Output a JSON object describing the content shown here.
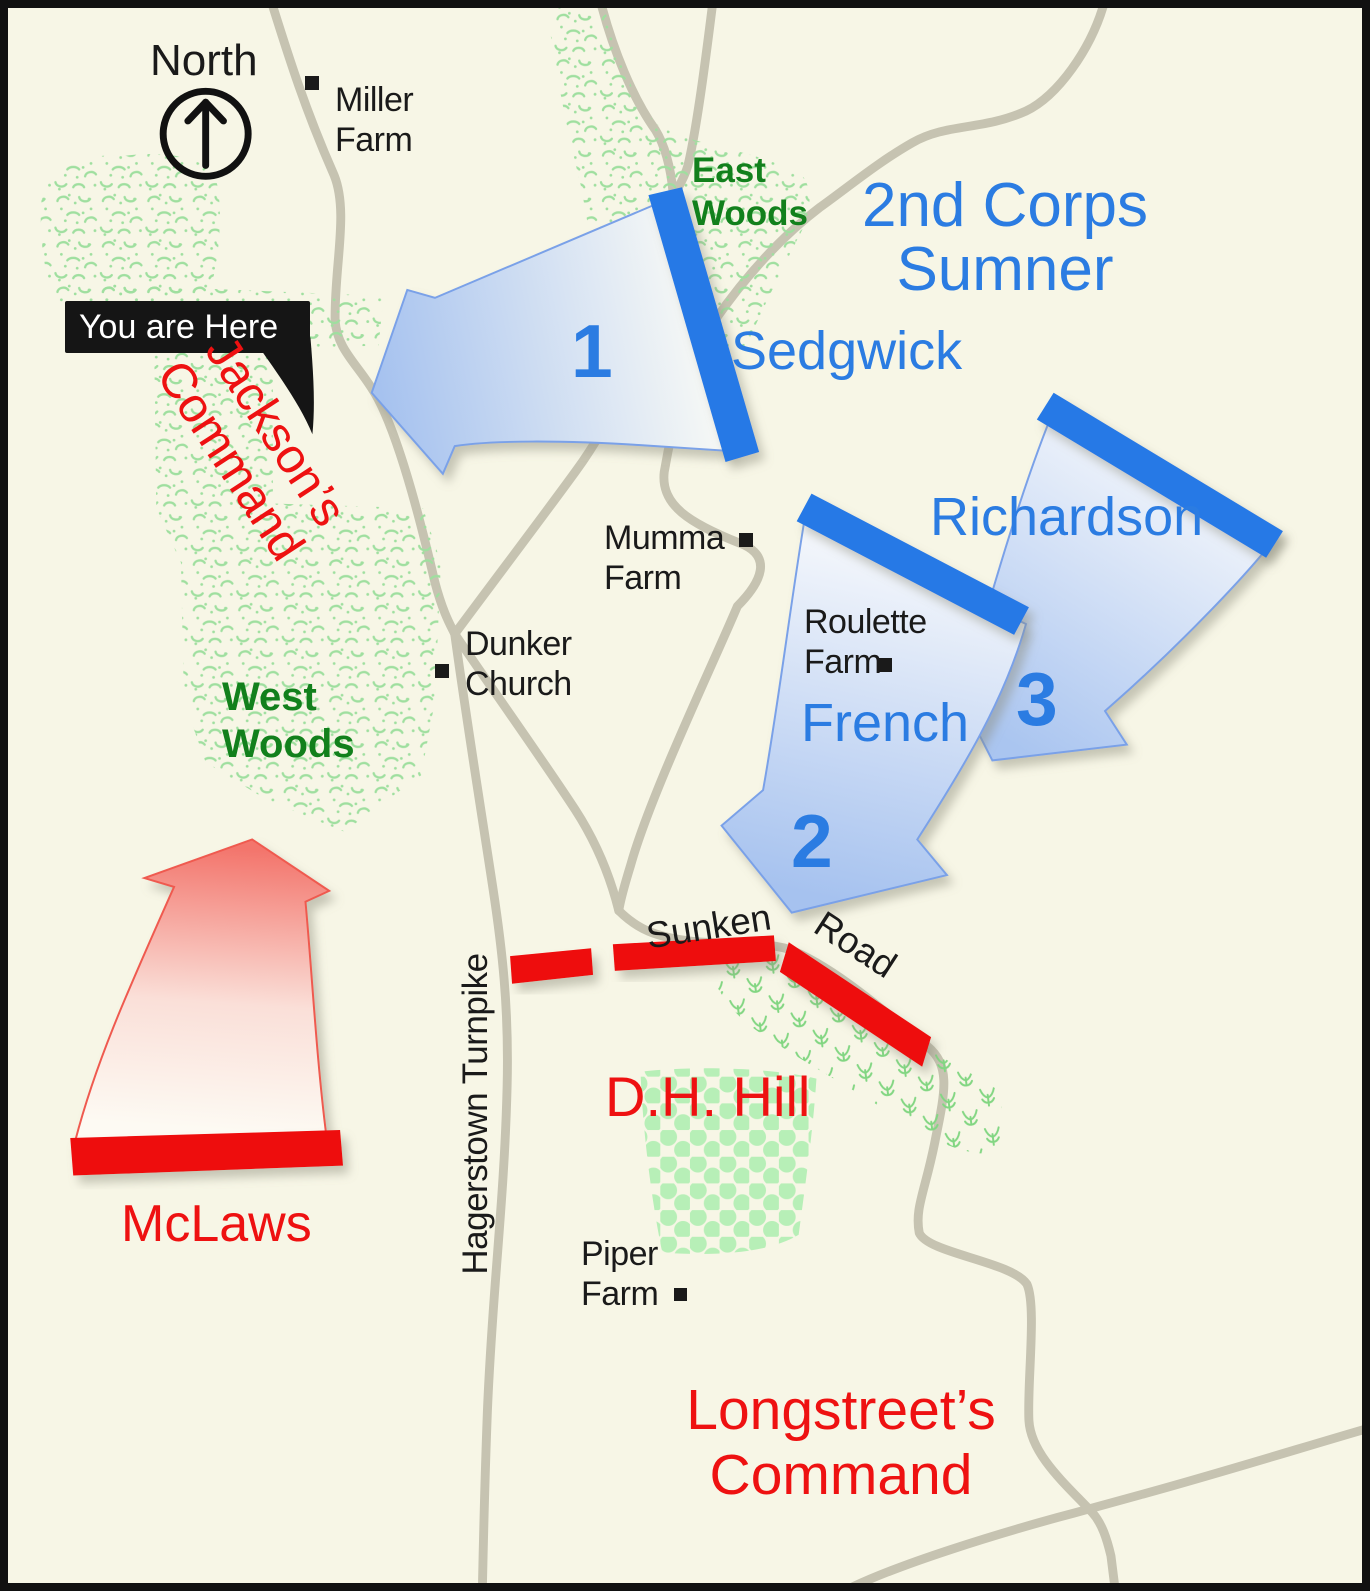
{
  "colors": {
    "bg": "#f7f6e6",
    "road": "#c6c3b1",
    "union_blue": "#2579e6",
    "union_text": "#2b7ce2",
    "confed_red": "#ee1111",
    "woods_green": "#9fdf9f",
    "label_green": "#12801c",
    "label_black": "#1a1a1a",
    "callout_bg": "#151515",
    "callout_text": "#ffffff"
  },
  "compass": {
    "label": "North"
  },
  "callout": {
    "label": "You are Here"
  },
  "union": {
    "corps": {
      "line1": "2nd Corps",
      "line2": "Sumner"
    },
    "sedgwick": {
      "name": "Sedgwick",
      "number": "1"
    },
    "french": {
      "name": "French",
      "number": "2"
    },
    "richardson": {
      "name": "Richardson",
      "number": "3"
    }
  },
  "confederate": {
    "jackson": {
      "line1": "Jackson’s",
      "line2": "Command"
    },
    "mclaws": {
      "name": "McLaws"
    },
    "dh_hill": {
      "name": "D.H. Hill"
    },
    "longstreet": {
      "line1": "Longstreet’s",
      "line2": "Command"
    }
  },
  "places": {
    "miller_farm": {
      "line1": "Miller",
      "line2": "Farm"
    },
    "east_woods": {
      "line1": "East",
      "line2": "Woods"
    },
    "west_woods": {
      "line1": "West",
      "line2": "Woods"
    },
    "mumma_farm": {
      "line1": "Mumma",
      "line2": "Farm"
    },
    "dunker_church": {
      "line1": "Dunker",
      "line2": "Church"
    },
    "roulette_farm": {
      "line1": "Roulette",
      "line2": "Farm"
    },
    "piper_farm": {
      "line1": "Piper",
      "line2": "Farm"
    },
    "sunken_road": {
      "word1": "Sunken",
      "word2": "Road"
    },
    "hagerstown_turnpike": {
      "label": "Hagerstown Turnpike"
    }
  }
}
